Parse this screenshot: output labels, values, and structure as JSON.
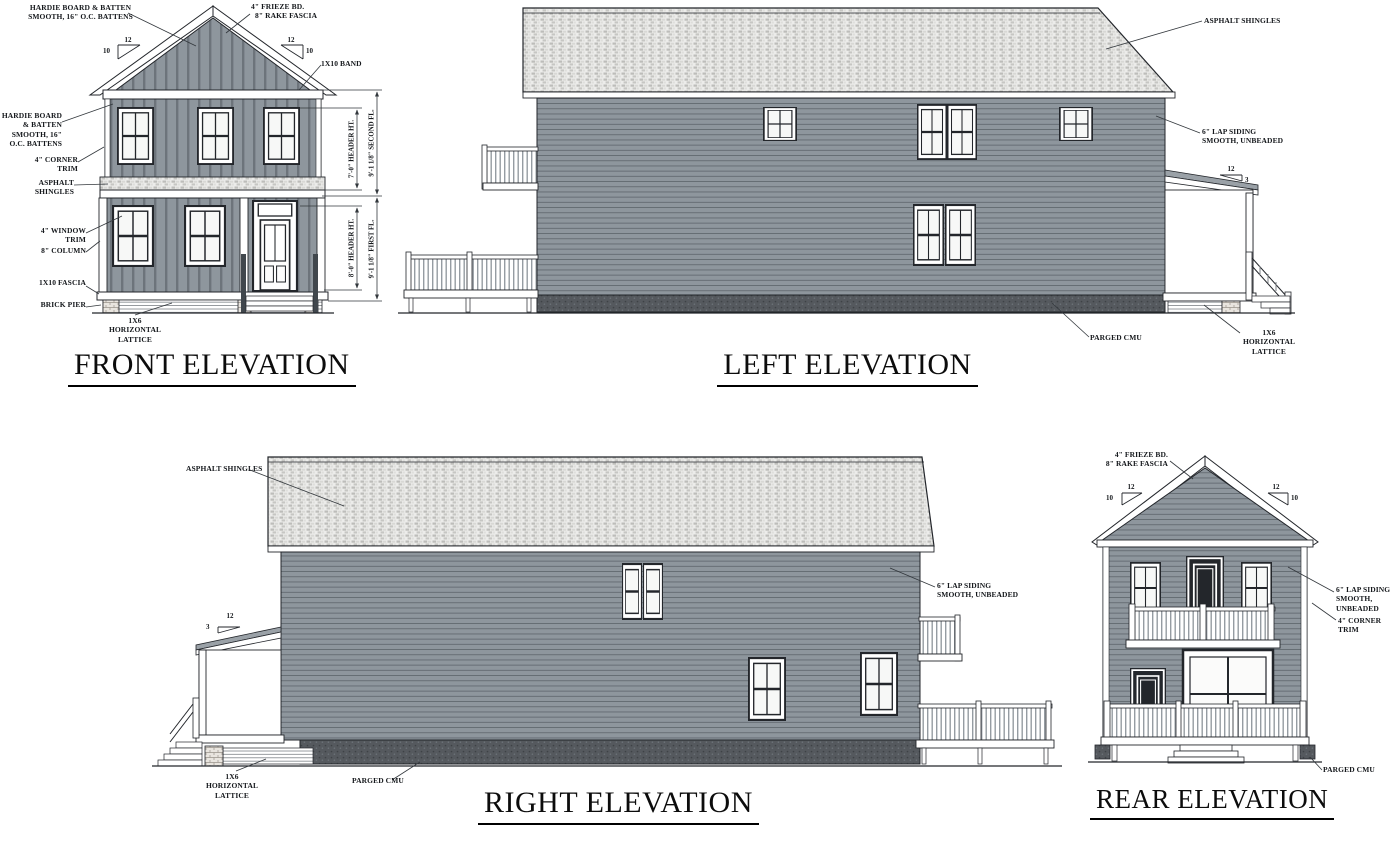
{
  "front": {
    "title": "FRONT ELEVATION",
    "slope": {
      "run": "12",
      "rise": "10"
    },
    "labels": {
      "board_batten_gable": "HARDIE BOARD & BATTEN\nSMOOTH, 16\" O.C. BATTENS",
      "frieze": "4\" FRIEZE BD.",
      "rake_fascia": "8\" RAKE FASCIA",
      "band": "1X10 BAND",
      "board_batten_wall": "HARDIE BOARD & BATTEN\nSMOOTH, 16\" O.C. BATTENS",
      "corner_trim": "4\" CORNER TRIM",
      "asphalt_shingles": "ASPHALT SHINGLES",
      "window_trim": "4\" WINDOW TRIM",
      "column": "8\" COLUMN",
      "fascia": "1X10 FASCIA",
      "brick_pier": "BRICK PIER",
      "lattice": "1X6 HORIZONTAL\nLATTICE"
    },
    "dimensions": {
      "second_header": "7'-0\" HEADER HT.",
      "second_floor": "9'-1 1/8\" SECOND FL.",
      "first_header": "8'-0\" HEADER HT.",
      "first_floor": "9'-1 1/8\" FIRST FL."
    }
  },
  "left": {
    "title": "LEFT ELEVATION",
    "slope": {
      "run": "12",
      "rise": "3"
    },
    "labels": {
      "asphalt_shingles": "ASPHALT SHINGLES",
      "lap_siding": "6\" LAP SIDING\nSMOOTH, UNBEADED",
      "parged_cmu": "PARGED CMU",
      "lattice": "1X6 HORIZONTAL\nLATTICE"
    }
  },
  "right": {
    "title": "RIGHT ELEVATION",
    "slope": {
      "run": "12",
      "rise": "3"
    },
    "labels": {
      "asphalt_shingles": "ASPHALT SHINGLES",
      "lap_siding": "6\" LAP SIDING\nSMOOTH, UNBEADED",
      "lattice": "1X6 HORIZONTAL\nLATTICE",
      "parged_cmu": "PARGED CMU"
    }
  },
  "rear": {
    "title": "REAR ELEVATION",
    "slope": {
      "run": "12",
      "rise": "10"
    },
    "labels": {
      "frieze": "4\" FRIEZE BD.",
      "rake_fascia": "8\" RAKE FASCIA",
      "lap_siding": "6\" LAP SIDING\nSMOOTH, UNBEADED",
      "corner_trim": "4\" CORNER TRIM",
      "parged_cmu": "PARGED CMU"
    }
  },
  "colors": {
    "siding": "#8e969d",
    "trim": "#ffffff",
    "roof_shingles": "#ececea",
    "foundation_cmu": "#55595e",
    "linework": "#1d1d1d"
  }
}
